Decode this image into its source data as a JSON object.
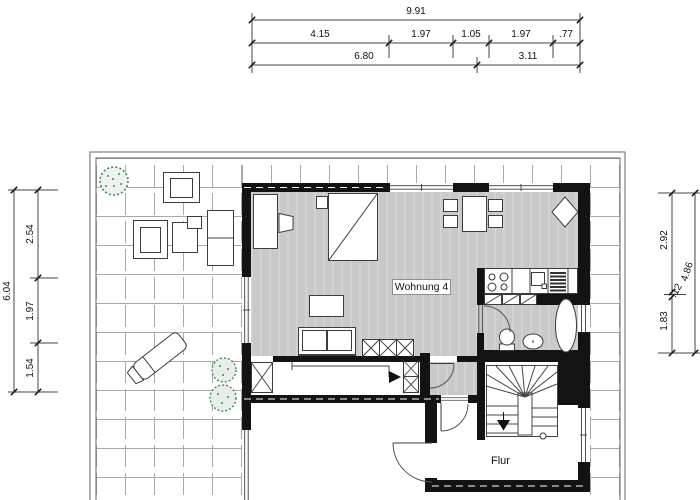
{
  "plan": {
    "type": "architectural-floor-plan",
    "apartment_label": "Wohnung 4",
    "hallway_label": "Flur"
  },
  "dimensions": {
    "top": {
      "total": "9.91",
      "segments": [
        "4.15",
        "1.97",
        "1.05",
        "1.97",
        ".77"
      ],
      "subtotals": [
        "6.80",
        "3.11"
      ]
    },
    "left": {
      "total": "6.04",
      "segments": [
        "2.54",
        "1.97",
        "1.54"
      ]
    },
    "right": {
      "total": "4.86",
      "segments": [
        "2.92",
        ".12",
        "1.83"
      ]
    }
  },
  "colors": {
    "wall": "#131313",
    "floor": "#c9c9c9",
    "tile_line": "#a9a9a9",
    "drawing_line": "#3c3c3c",
    "vegetation_green": "#47865a",
    "text": "#111111"
  },
  "rooms": [
    "Wohnung 4",
    "Flur"
  ],
  "fixtures": [
    "bed",
    "desk",
    "desk-chair",
    "nightstand",
    "dining-table",
    "dining-chair",
    "plant-diamond",
    "kitchen-counter",
    "stove-burners",
    "kitchen-sink",
    "dish-rack",
    "base-cabinets",
    "coffee-table",
    "sofa",
    "wardrobe-x",
    "toilet",
    "bidet",
    "bathtub",
    "winder-staircase",
    "stair-arrow",
    "sun-lounger",
    "terrace-table",
    "terrace-sofa",
    "tree",
    "shrub"
  ]
}
